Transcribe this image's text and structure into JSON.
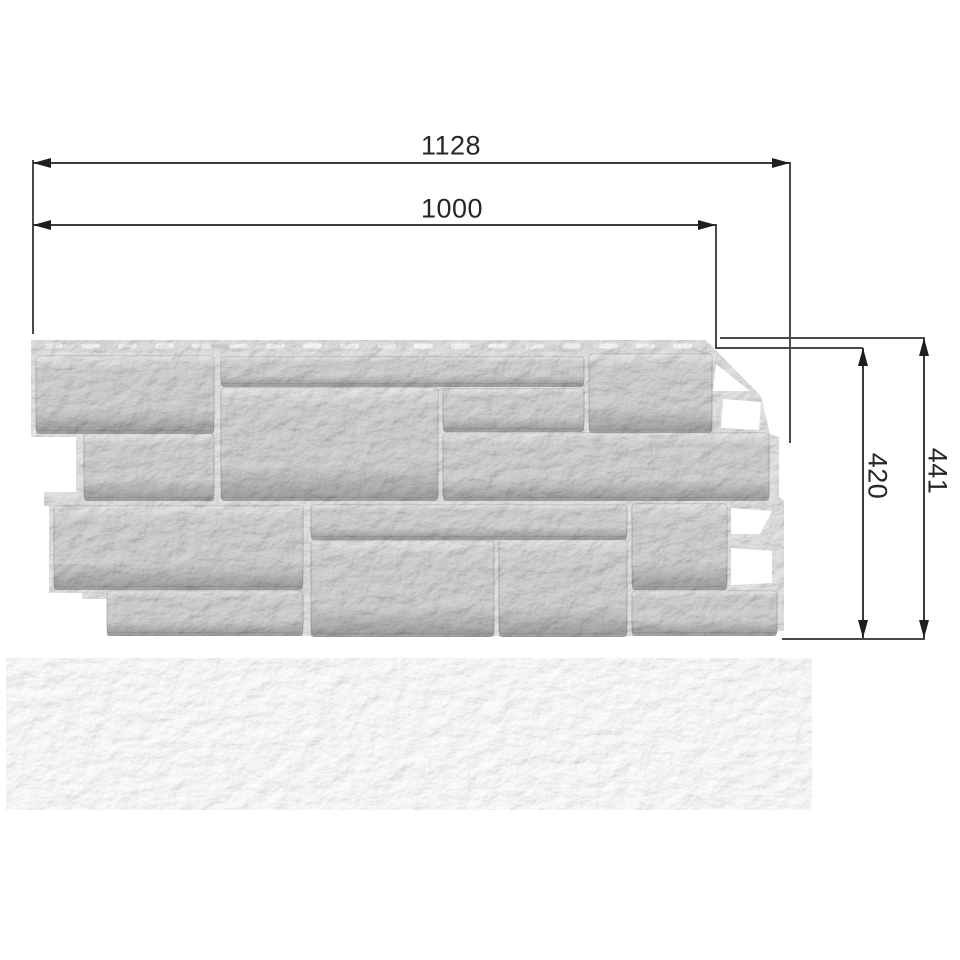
{
  "product_drawing": {
    "dimensions": {
      "total_width_mm": "1128",
      "working_width_mm": "1000",
      "working_height_mm": "420",
      "total_height_mm": "441"
    },
    "colors": {
      "dimension_line": "#3a3a3a",
      "dimension_text": "#262626",
      "arrowhead": "#1e1e1e",
      "background": "#ffffff",
      "panel_backing": "#e6e6e6",
      "panel_hem": "#e2e2e2",
      "hem_slot": "#fafafa",
      "panel_stone": "#d4d4d4",
      "panel_stone_shadow": "#a6a6a6",
      "edge_cutout": "#ffffff"
    }
  }
}
